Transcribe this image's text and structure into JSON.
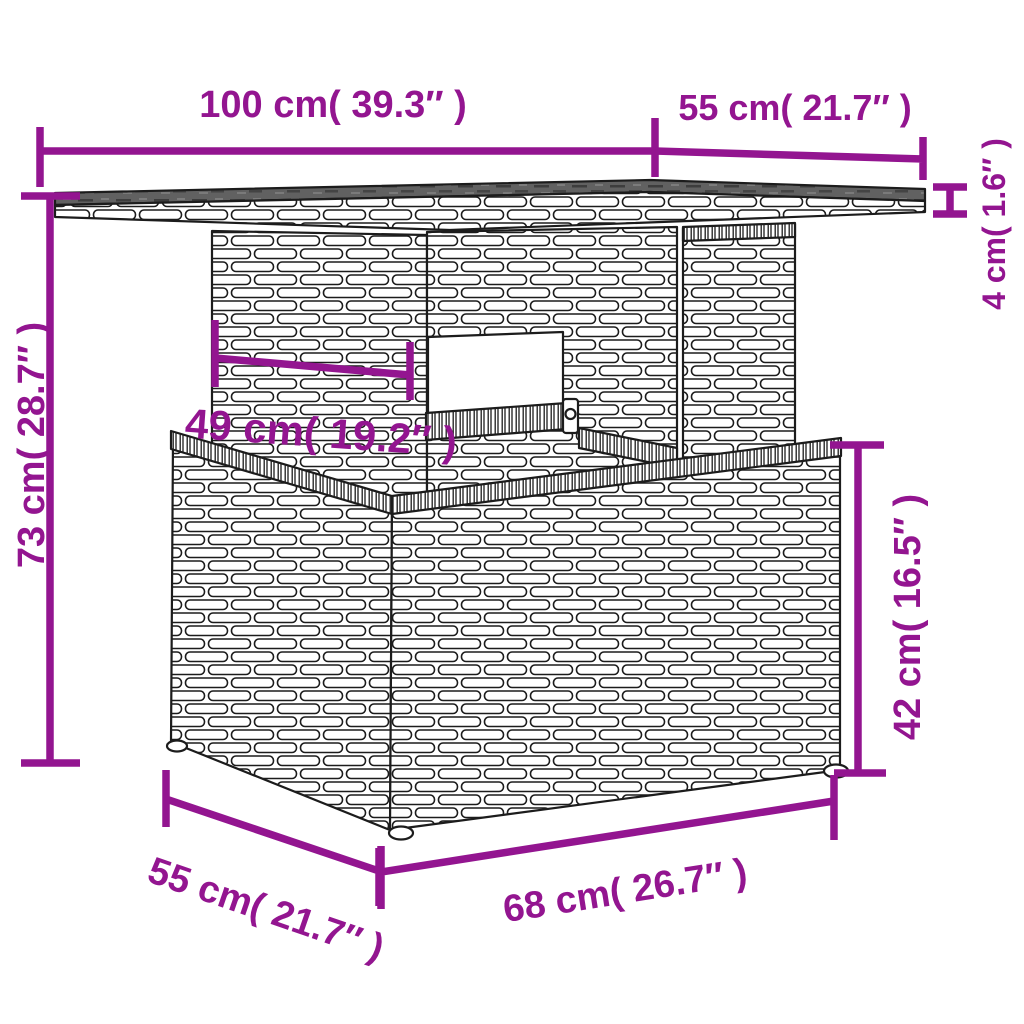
{
  "diagram_type": "furniture-dimension-diagram",
  "product": "rattan-table-illustration",
  "colors": {
    "dimension_accent": "#931590",
    "outline": "#1c1c1c",
    "glass_top": "#606060",
    "wicker_fill": "#ffffff",
    "background": "#ffffff"
  },
  "dimensions": {
    "table_width": {
      "label": "100 cm( 39.3″ )"
    },
    "table_depth": {
      "label": "55 cm( 21.7″ )"
    },
    "top_thickness": {
      "label": "4 cm( 1.6″ )"
    },
    "overall_height": {
      "label": "73 cm( 28.7″ )"
    },
    "understructure_width": {
      "label": "49 cm( 19.2″ )"
    },
    "base_height": {
      "label": "42 cm( 16.5″ )"
    },
    "base_width": {
      "label": "68 cm( 26.7″ )"
    },
    "base_depth": {
      "label": "55 cm( 21.7″ )"
    }
  }
}
